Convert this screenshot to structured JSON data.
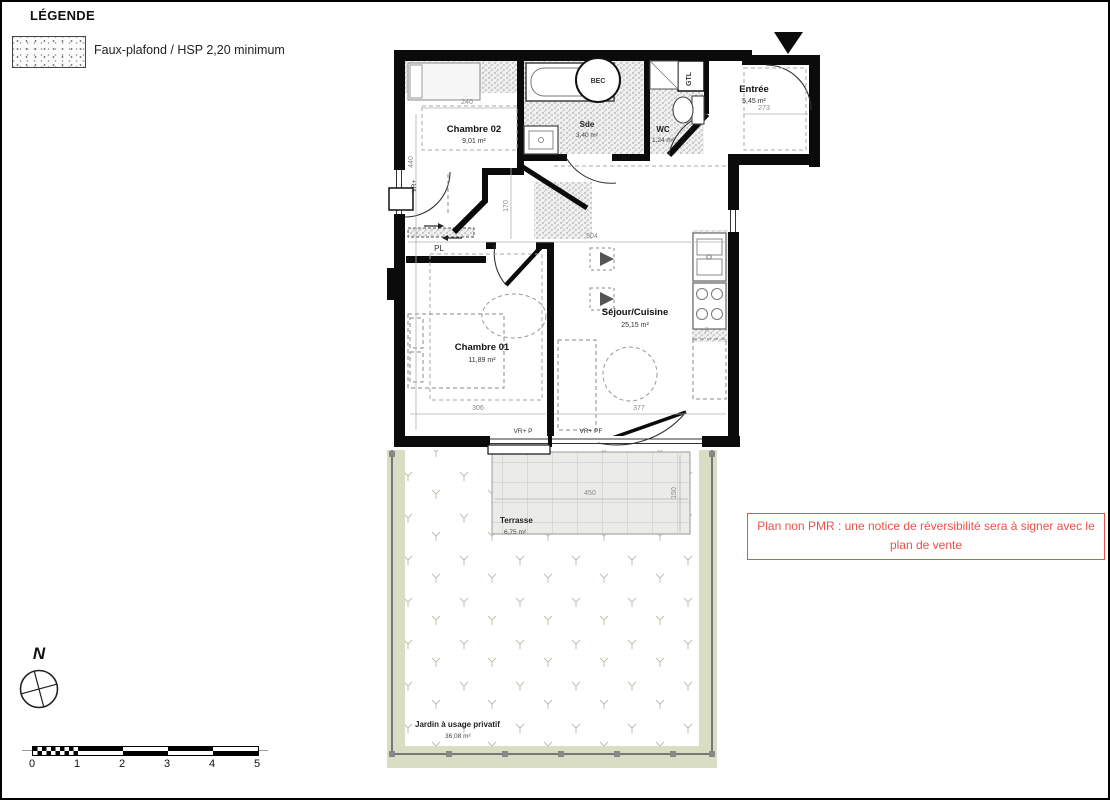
{
  "legend": {
    "title": "LÉGENDE",
    "item_label": "Faux-plafond / HSP 2,20 minimum"
  },
  "plan": {
    "rooms": {
      "chambre02": {
        "name": "Chambre 02",
        "area": "9,01 m²"
      },
      "sde": {
        "name": "Sde",
        "area": "3,40 m²"
      },
      "wc": {
        "name": "WC",
        "area": "1,24 m²"
      },
      "entree": {
        "name": "Entrée",
        "area": "5,45 m²"
      },
      "sejour_cuisine": {
        "name": "Séjour/Cuisine",
        "area": "25,15 m²"
      },
      "chambre01": {
        "name": "Chambre 01",
        "area": "11,89 m²"
      },
      "terrasse": {
        "name": "Terrasse",
        "area": "6,75 m²"
      },
      "jardin": {
        "name": "Jardin à usage privatif",
        "area": "36,08 m²"
      }
    },
    "fixture_labels": {
      "bec": "BEC",
      "gtl": "GTL",
      "placard": "PL",
      "refrigerator": "R"
    },
    "window_labels": {
      "vr": "VR+",
      "vr_p": "VR+ P",
      "vr_pf": "VR+ PF"
    },
    "dimensions": {
      "chambre02_width": "240",
      "left_height": "440",
      "hall_height": "170",
      "sejour_width": "504",
      "chambre01_width": "306",
      "sejour_bottom_width": "377",
      "entree_width": "273",
      "terrasse_width": "450",
      "terrasse_depth": "150"
    }
  },
  "note": {
    "line1": "Plan non PMR : une notice de réversibilité sera à signer avec le",
    "line2": "plan de vente"
  },
  "compass": {
    "label": "N"
  },
  "scale_bar": {
    "ticks": [
      "0",
      "1",
      "2",
      "3",
      "4",
      "5"
    ]
  },
  "colors": {
    "note_red": "#e8524a",
    "jardin_band": "#d9ddc3",
    "terrace_fill": "#ebebe7",
    "wall_black": "#0b0b0b"
  }
}
